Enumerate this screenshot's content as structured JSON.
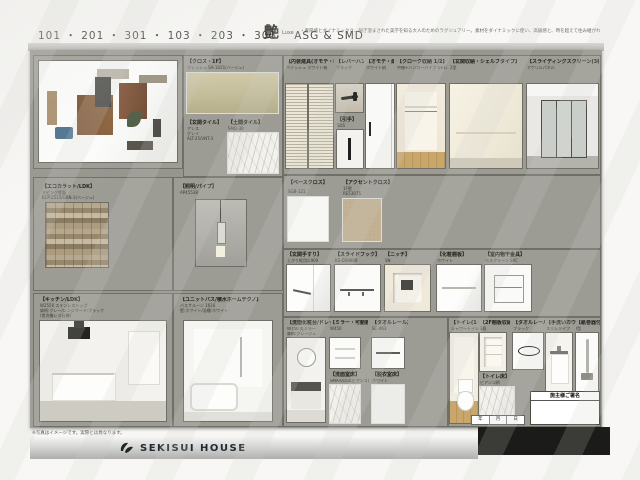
{
  "header": {
    "room_numbers": "101 ・ 201 ・ 301 ・ 103 ・ 203 ・ 303",
    "plan_code": "ASG & SMD",
    "style_kanji": "艶",
    "style_romaji": "Luxe",
    "style_description": "・重厚感とダイナミックさ、研ぎ澄まされた美学を知る大人のためのラグジュアリー。素材をダイナミックに使い、高級感と、時を超えて住み継がれる趣を感じる住まいに。"
  },
  "cloth_panel": {
    "wallpaper_label": "【クロス・1F】",
    "wallpaper_code": "フレッシュ SA-1021(ベージュ)",
    "tile1_label": "【玄関タイル】",
    "tile1_line1": "アレス",
    "tile1_line2": "グレイ",
    "tile1_line3": "ALT-25/VNT-3",
    "tile2_label": "【土間タイル】",
    "tile2_code": "SMD-30"
  },
  "doors": {
    "d1_label": "【内装建具(オモテ・収納)】",
    "d1_sub": "ベリッシュ ホワイト柄",
    "d2_label": "【レバーハンドル】",
    "d2_sub": "ブラック",
    "hikite_label": "【引手】",
    "hikite_sub": "SUS",
    "d3_label": "【オモテ・建具】",
    "d3_sub": "ホワイト柄",
    "d4_label": "【クローク収納 1/2】",
    "d4_sub": "中棚+ハンガーパイプ 1+1/2セット",
    "d5_label": "【玄関収納・シェルフタイプ】",
    "d5_sub": "2型",
    "d6_label": "【スライディングスクリーン(3枚)タイプ】",
    "d6_sub": "アクリルパネル"
  },
  "ecocarat": {
    "label": "【エコカラット/LDK】",
    "line1": "リビング壁面",
    "line2": "ECP-2515/GRN-1(ベージュ)"
  },
  "light": {
    "label": "【照明/パイプ】",
    "code": "AP45538"
  },
  "base_cloth": {
    "label": "【ベースクロス】",
    "code": "SGB-121"
  },
  "accent_cloth": {
    "label": "【アクセントクロス】",
    "line1": "1F壁",
    "line2": "RE53075"
  },
  "fixtures": [
    {
      "label": "【玄関手すり】",
      "sub": "上がり框用/L900"
    },
    {
      "label": "【スライドフック】",
      "sub": "KS-DS9009"
    },
    {
      "label": "【ニッチ】",
      "sub": "SN"
    },
    {
      "label": "【化粧棚板】",
      "sub": "ホワイト"
    },
    {
      "label": "【室内物干金具】",
      "sub": "ホスクリーン SPC"
    }
  ],
  "kitchen": {
    "label": "【キッチン/LDK】",
    "line1": "W2550 ステンレストップ",
    "line2": "扉柄:グレー/レンジフード:ブラック",
    "line3": "(食洗機レス仕様)"
  },
  "bath": {
    "label": "【ユニットバス/積水ホームテクノ】",
    "line1": "バスサルーン 1616",
    "line2": "壁:ホワイト/浴槽:ホワイト"
  },
  "washroom": {
    "vanity_label": "【洗面化粧台/ドレッサA】",
    "vanity_line1": "W750 丸ミラー",
    "vanity_line2": "扉柄:グレージュ",
    "shelf_label": "【ミラー・可動棚】",
    "shelf_sub": "W450",
    "rail_label": "【タオルレール】",
    "rail_sub": "SC-463",
    "floor_label": "【洗面室床】",
    "floor_sub": "SMA-0151(ビアンコ)",
    "floor2_label": "【脱衣室床】",
    "floor2_sub": "ホワイト"
  },
  "toilet": {
    "main_label": "【トイレ(1・2F)】",
    "main_sub": "シャワートイレ一体型",
    "shelf_label": "【2F棚板収納】",
    "shelf_sub": "3段",
    "ring_label": "【タオルレール】",
    "ring_sub": "ブラック",
    "handwash_label": "【手洗いカウンター】",
    "handwash_sub": "スリムタイプ",
    "handrail_label": "【紙巻器付手すり】",
    "handrail_sub": "I型",
    "floor_label": "【トイレ床】",
    "floor_sub": "ビアンコ柄"
  },
  "signature": {
    "title": "施主様ご署名"
  },
  "date_row": {
    "c1": "年",
    "c2": "月",
    "c3": "日"
  },
  "footer": {
    "note": "※写真はイメージです。実際とは異なります。",
    "brand": "SEKISUI HOUSE"
  },
  "colors": {
    "board": "#9c9b94",
    "olive_swatch": "#c8c19e",
    "accent_swatch": "#c2b193",
    "black_bar": "#1b1b19"
  }
}
